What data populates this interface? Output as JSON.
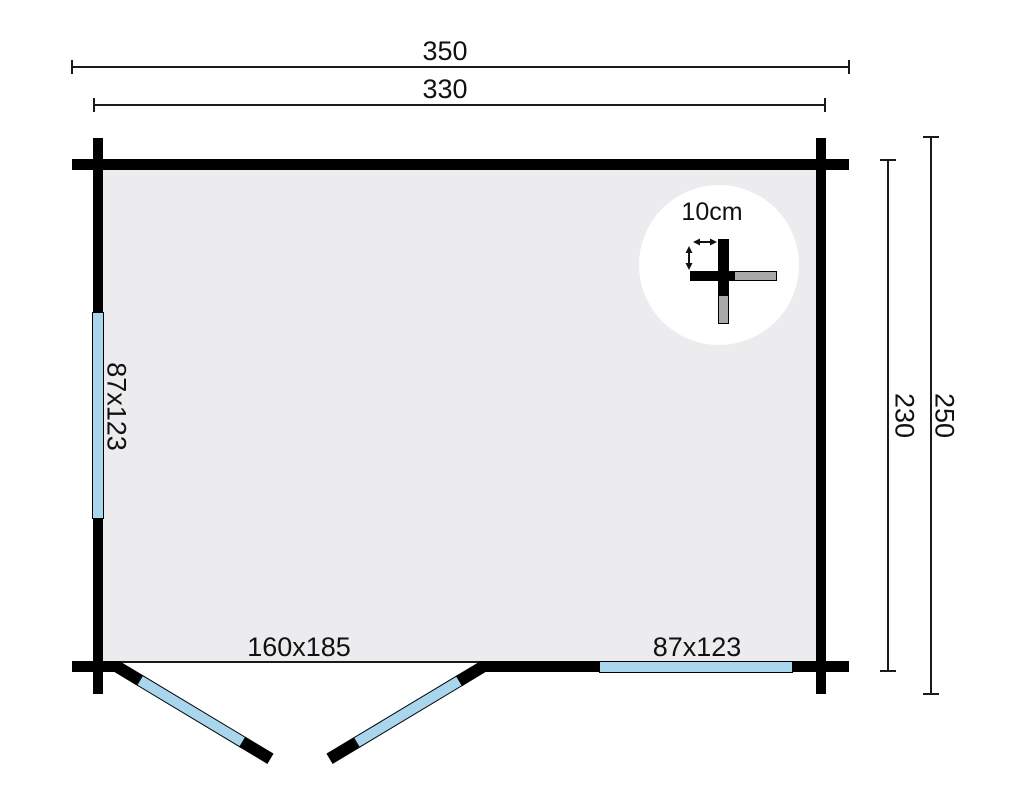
{
  "plan": {
    "dim_top_outer": "350",
    "dim_top_inner": "330",
    "dim_right_inner": "230",
    "dim_right_outer": "250",
    "window_left_label": "87x123",
    "window_bottom_label": "87x123",
    "door_label": "160x185",
    "detail_label": "10cm"
  },
  "colors": {
    "wall": "#000000",
    "floor": "#ececee",
    "glazing": "#a9d6ec",
    "detail_gray": "#a9a9a9",
    "dimension_line": "#1a1a1a",
    "background": "#ffffff"
  }
}
